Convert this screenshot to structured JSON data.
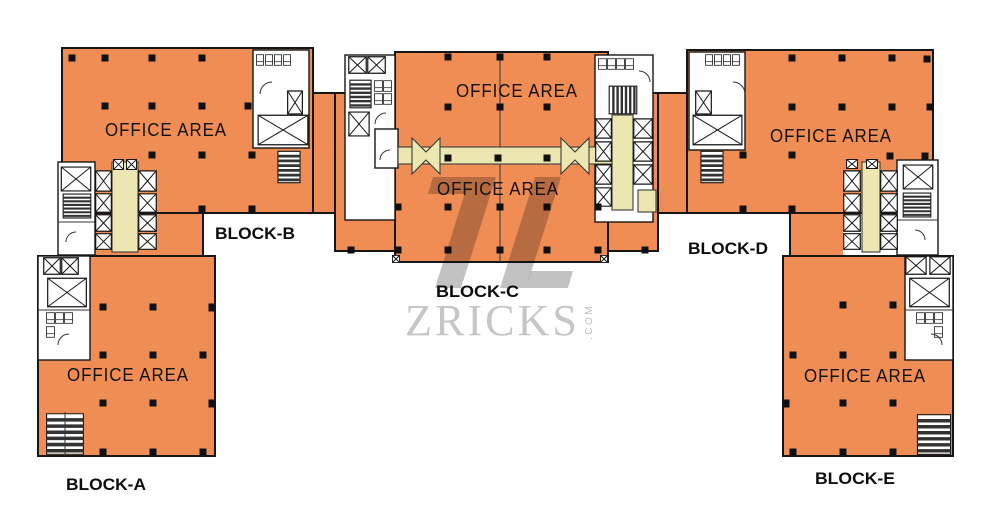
{
  "labels": {
    "office_area": "OFFICE AREA",
    "block_a": "BLOCK-A",
    "block_b": "BLOCK-B",
    "block_c": "BLOCK-C",
    "block_d": "BLOCK-D",
    "block_e": "BLOCK-E"
  },
  "watermark": {
    "brand": "ZRICKS",
    "suffix": ".COM"
  },
  "colors": {
    "office": "#F08D55",
    "lobby": "#ECE7B0",
    "outline": "#161616",
    "column": "#101010",
    "watermark_text": "#C6C6C6",
    "watermark_shape": "#C2C2C2"
  }
}
